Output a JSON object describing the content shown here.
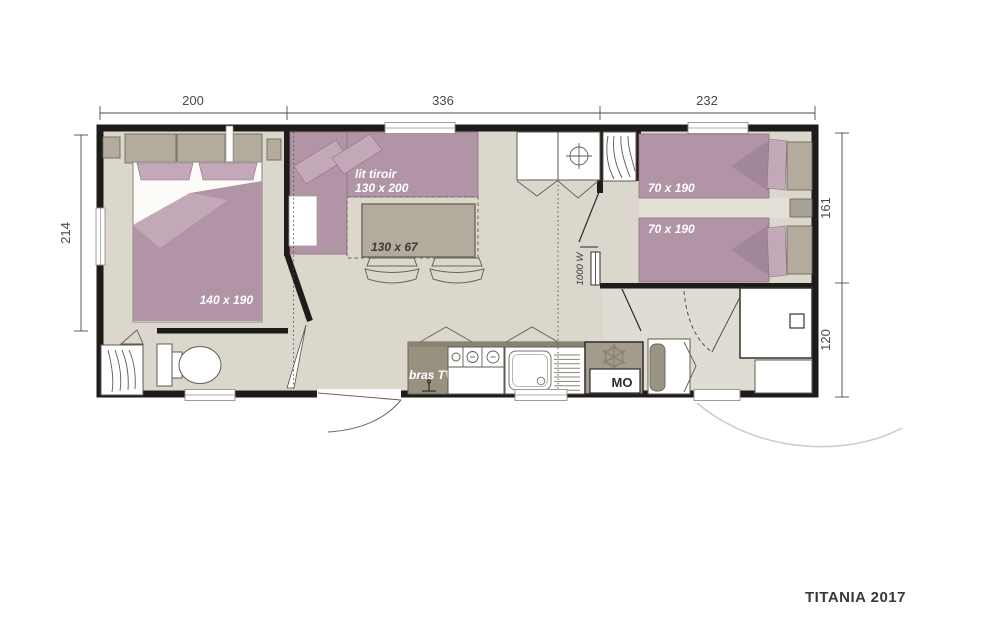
{
  "title": "TITANIA 2017",
  "dimensions": {
    "top": [
      {
        "label": "200"
      },
      {
        "label": "336"
      },
      {
        "label": "232"
      }
    ],
    "left": {
      "label": "214"
    },
    "right": [
      {
        "label": "161"
      },
      {
        "label": "120"
      }
    ]
  },
  "labels": {
    "master_bed": "140 x 190",
    "sofa_line1": "lit tiroir",
    "sofa_line2": "130 x 200",
    "table": "130 x 67",
    "twin_bed_top": "70 x 190",
    "twin_bed_bottom": "70 x 190",
    "tv": "bras TV",
    "microwave": "MO",
    "heater": "1000 W"
  },
  "colors": {
    "wall": "#1d1c1a",
    "floor": "#dbd7cc",
    "floor_light": "#e2dfd6",
    "mauve": "#b294a7",
    "mauve_light": "#c3a9b8",
    "cabinet_gray": "#b2ab9e",
    "counter_gray": "#999180",
    "fridge_gray": "#a39b8b",
    "dim_text": "#4a4a47"
  }
}
